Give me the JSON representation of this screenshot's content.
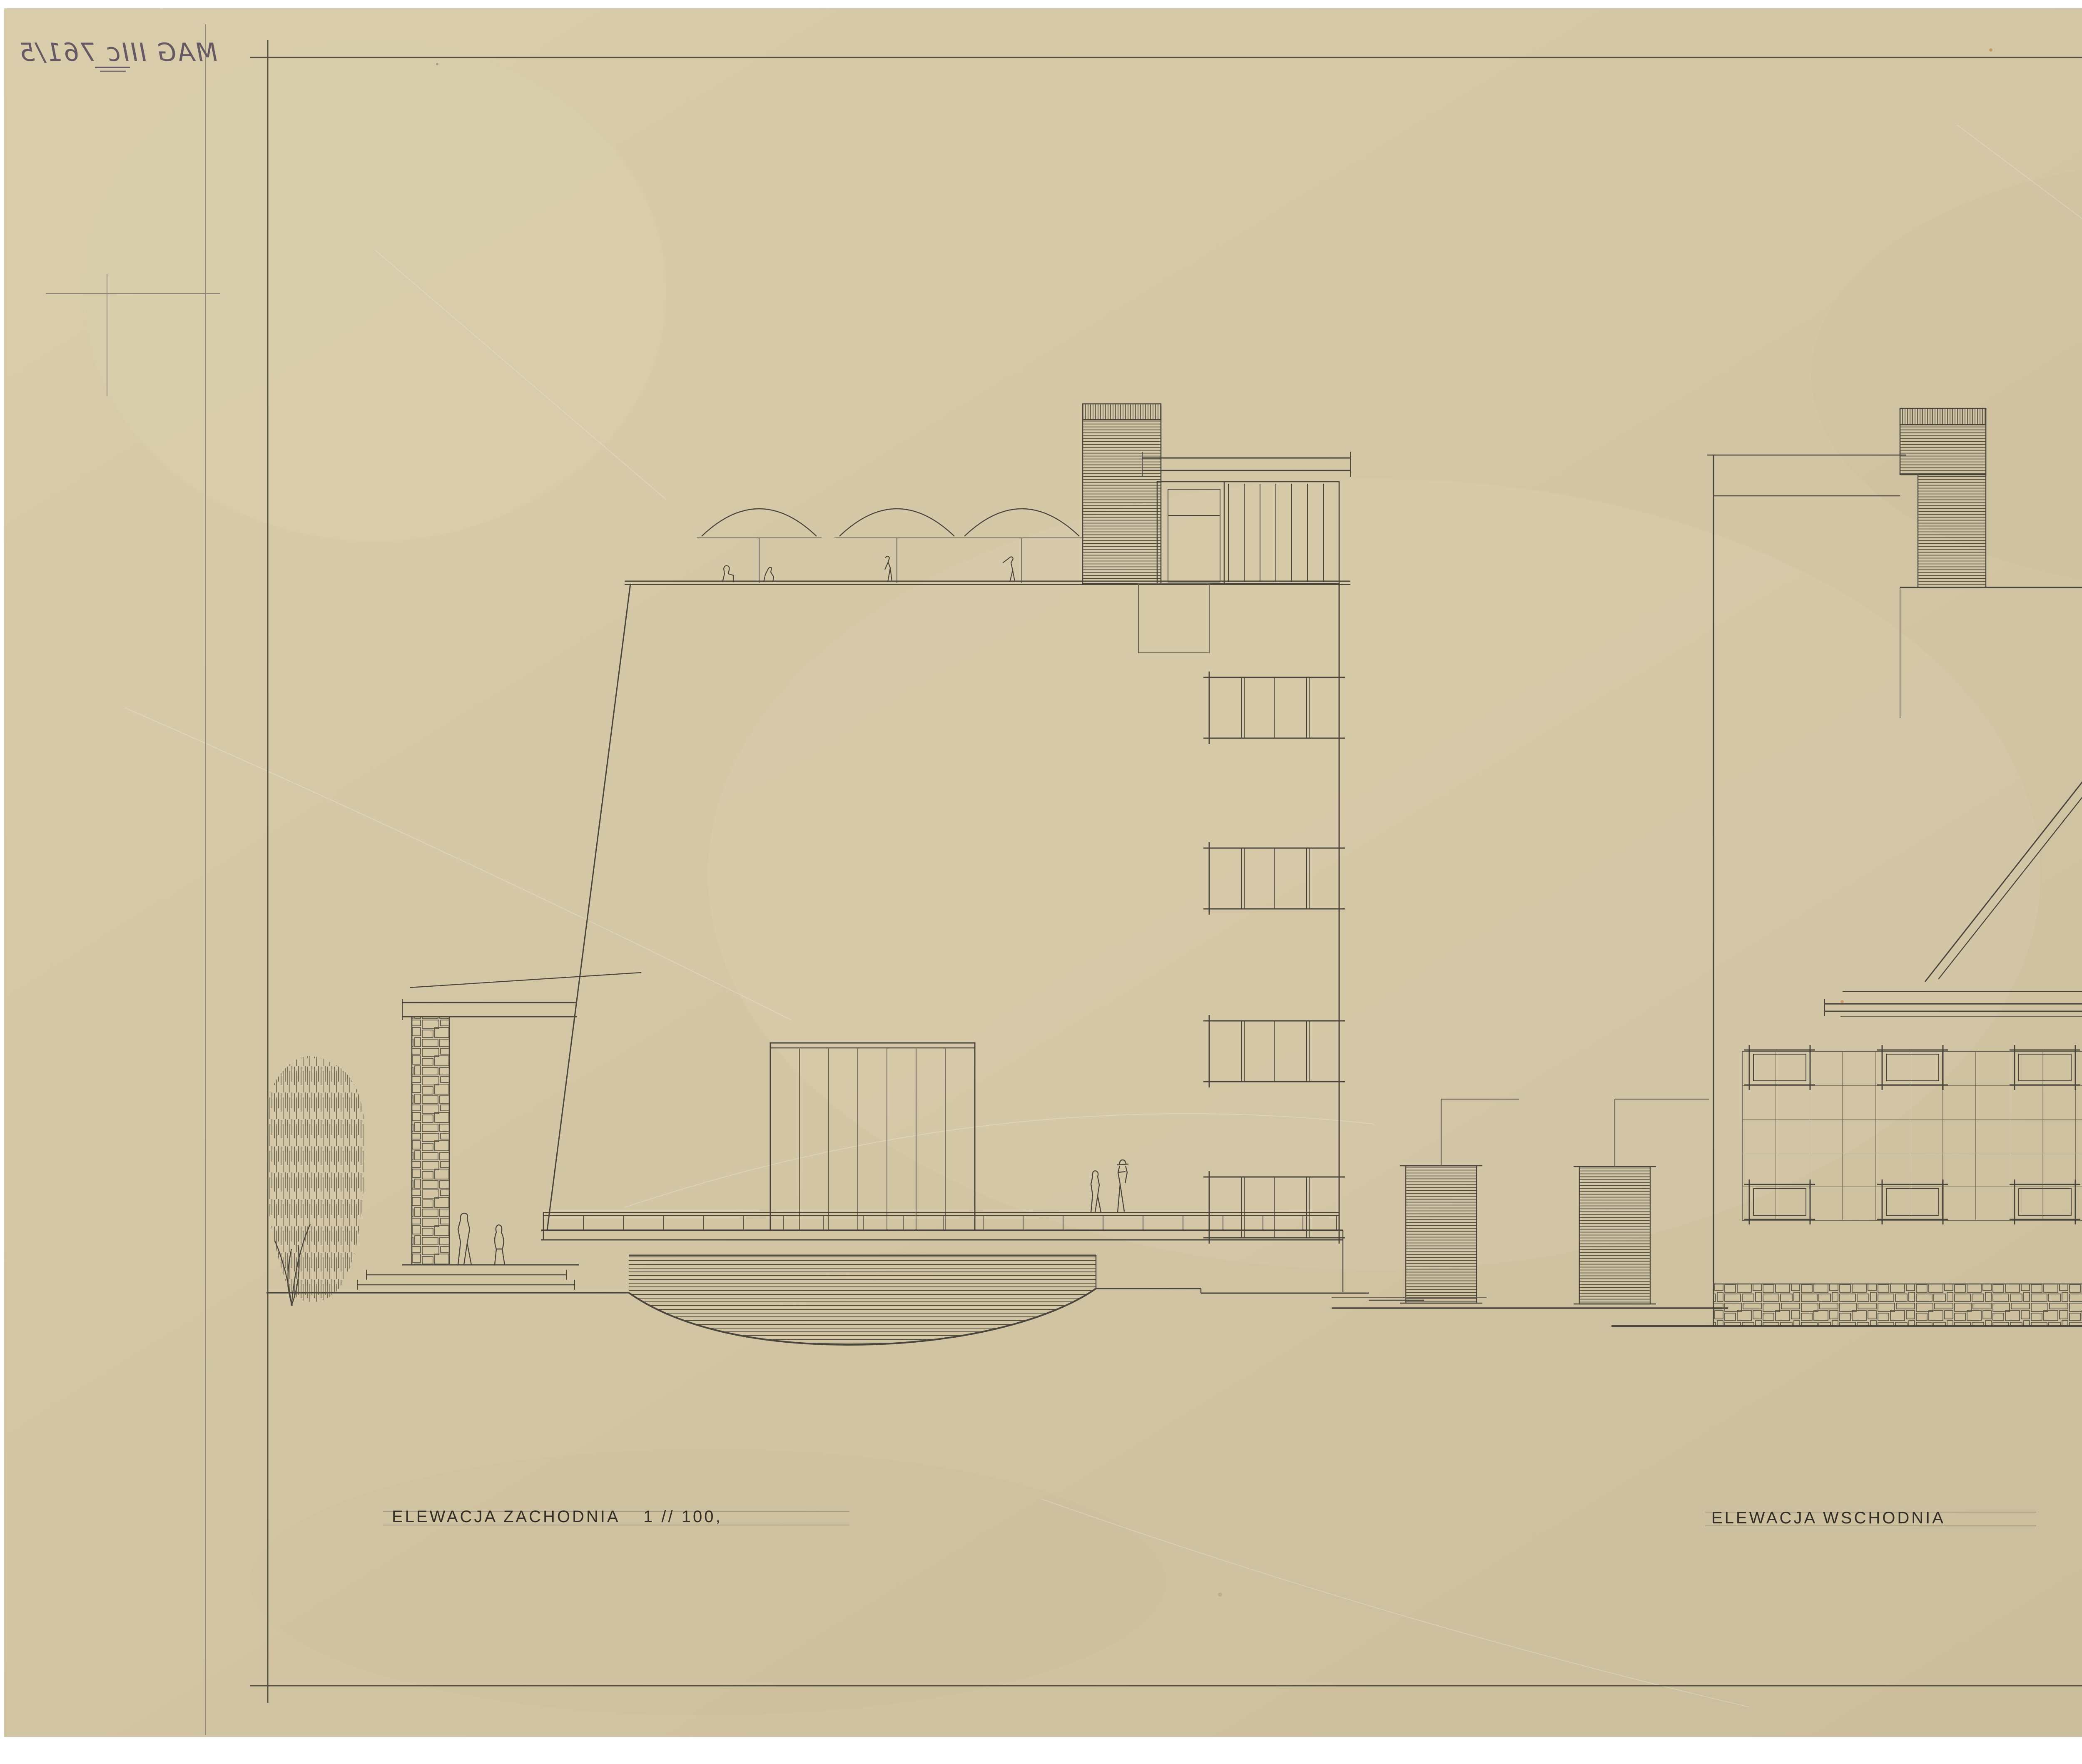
{
  "document": {
    "kind": "scanned architectural elevation drawing, pencil on aged tracing paper"
  },
  "archive_number": {
    "text": "MAG IIIc 761/5",
    "presentation": "mirrored handwriting, top-left corner"
  },
  "labels": {
    "west_elevation": "ELEWACJA ZACHODNIA",
    "west_scale": "1 // 100,",
    "east_elevation": "ELEWACJA WSCHODNIA"
  },
  "title_block": {
    "line1": "PAWILON WIDOWISKOWY",
    "line2": "W P O L A N I C Y",
    "line3": "SZKIC DO ZAŁOŻEŃ WSTĘPNYCH,",
    "signature": "Prof. Andrzej Frydecki",
    "line4": "WROCŁAW,  DNIA 25 marca 1963 R."
  },
  "colors": {
    "scan_background": "#ffffff",
    "paper": "#d3c6a4",
    "ink": "#4a463c",
    "faint_line": "#8f8776",
    "handwriting": "#655a64"
  }
}
